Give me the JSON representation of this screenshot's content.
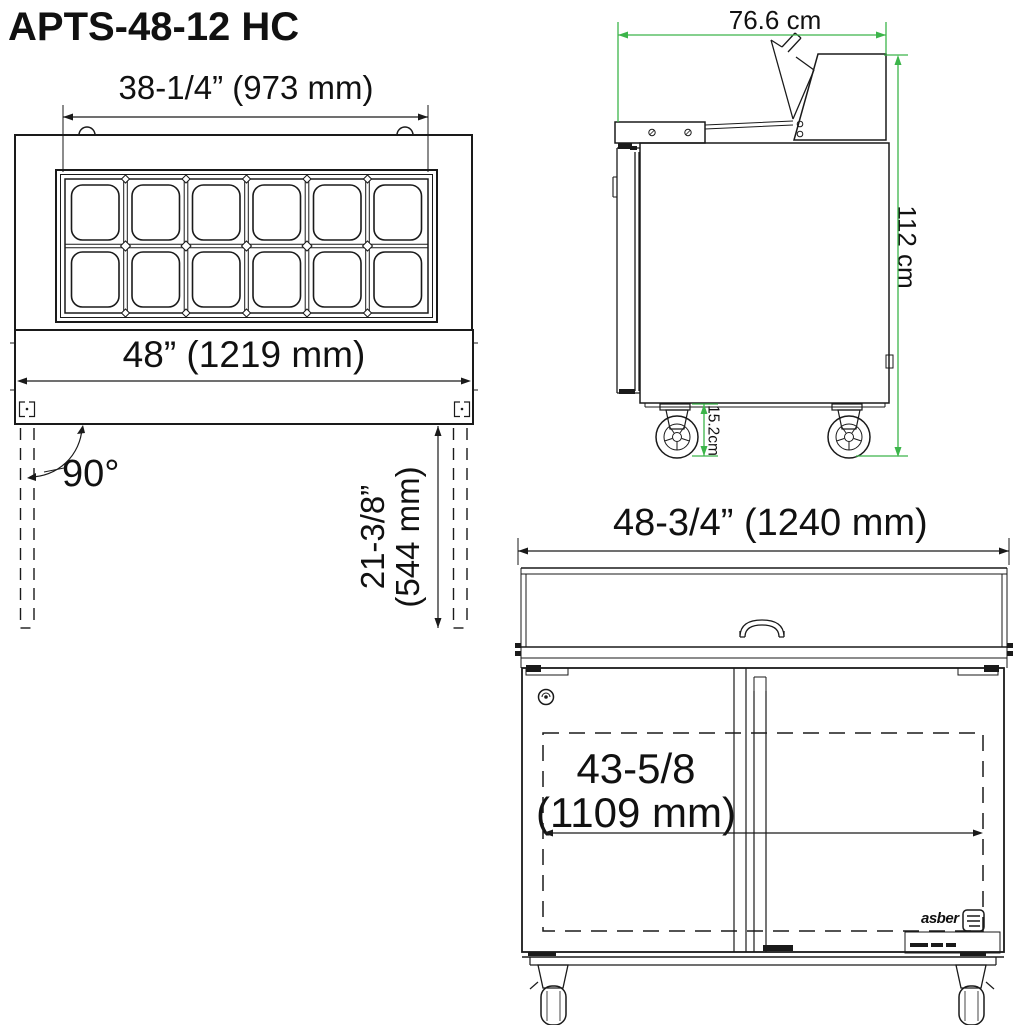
{
  "title": "APTS-48-12 HC",
  "colors": {
    "line": "#1a1a1a",
    "dim_green": "#3cb54a",
    "background": "#ffffff"
  },
  "top_view": {
    "width_top_label": "38-1/4” (973 mm)",
    "width_full_label": "48” (1219 mm)",
    "door_angle_label": "90°",
    "door_depth_label_line1": "21-3/8”",
    "door_depth_label_line2": "(544 mm)",
    "pan_rows": 2,
    "pan_cols": 6
  },
  "side_view": {
    "depth_label": "76.6 cm",
    "height_label": "112 cm",
    "caster_height_label": "15.2cm"
  },
  "front_view": {
    "width_label": "48-3/4” (1240 mm)",
    "interior_width_label_line1": "43-5/8",
    "interior_width_label_line2": "(1109 mm)",
    "brand": "asber"
  }
}
